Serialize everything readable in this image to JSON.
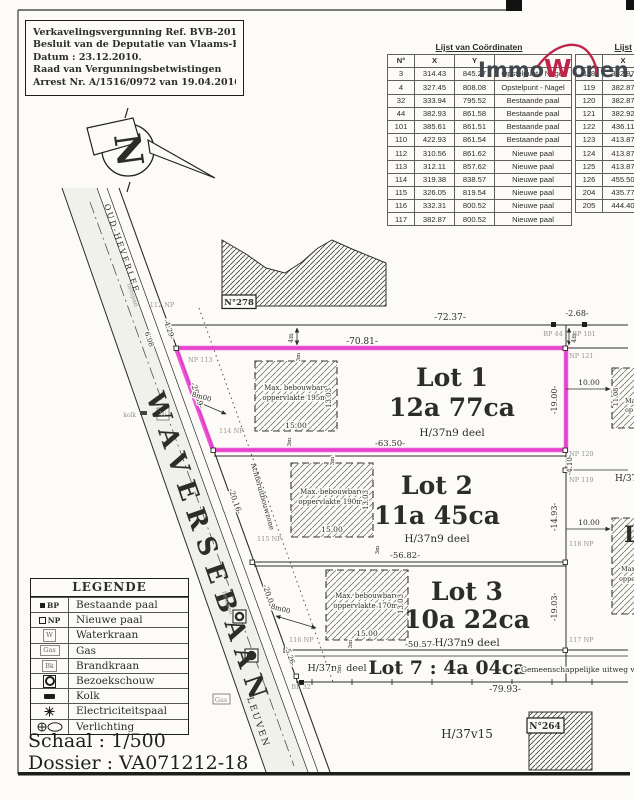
{
  "header": {
    "permit_lines": [
      "Verkavelingsvergunning Ref. BVB-2010581",
      "Besluit van de Deputatie van Vlaams-Brabant",
      "Datum : 23.12.2010.",
      "Raad van Vergunningsbetwistingen",
      "Arrest Nr. A/1516/0972 van 19.04.2016."
    ]
  },
  "logo": {
    "immo": "Immo",
    "w": "W",
    "onen": "onen",
    "be": ".be"
  },
  "coord_table": {
    "title": "Lijst van Coördinaten",
    "columns": [
      "N°",
      "X",
      "Y",
      ""
    ],
    "rows": [
      [
        "3",
        "314.43",
        "845.27",
        "Opstelpunt - Nagel"
      ],
      [
        "4",
        "327.45",
        "808.08",
        "Opstelpunt - Nagel"
      ],
      [
        "32",
        "333.94",
        "795.52",
        "Bestaande paal"
      ],
      [
        "44",
        "382.93",
        "861.58",
        "Bestaande paal"
      ],
      [
        "101",
        "385.61",
        "861.51",
        "Bestaande paal"
      ],
      [
        "110",
        "422.93",
        "861.54",
        "Bestaande paal"
      ],
      [
        "112",
        "310.56",
        "861.62",
        "Nieuwe paal"
      ],
      [
        "113",
        "312.11",
        "857.62",
        "Nieuwe paal"
      ],
      [
        "114",
        "319.38",
        "838.57",
        "Nieuwe paal"
      ],
      [
        "115",
        "326.05",
        "819.54",
        "Nieuwe paal"
      ],
      [
        "116",
        "332.31",
        "800.52",
        "Nieuwe paal"
      ],
      [
        "117",
        "382.87",
        "800.52",
        "Nieuwe paal"
      ]
    ]
  },
  "coord_table_right": {
    "title": "Lijst",
    "columns": [
      "",
      "X"
    ],
    "rows": [
      [
        "118",
        "382.87"
      ],
      [
        "119",
        "382.87"
      ],
      [
        "120",
        "382.87"
      ],
      [
        "121",
        "382.92"
      ],
      [
        "122",
        "436.11"
      ],
      [
        "123",
        "413.87"
      ],
      [
        "124",
        "413.87"
      ],
      [
        "125",
        "413.87"
      ],
      [
        "126",
        "455.50"
      ],
      [
        "204",
        "435.77"
      ],
      [
        "205",
        "444.40"
      ]
    ]
  },
  "plan": {
    "north": "N",
    "parcels": {
      "n278": "N°278",
      "n264": "N°264",
      "h37v15": "H/37v15"
    },
    "road": {
      "name": "WAVERSEBAAN",
      "dir_top": "OUD-HEVERLEE",
      "dir_bottom": "LEUVEN",
      "fietspad": "fietspad",
      "kolk": "kolk",
      "w": "W",
      "gas": "Gas",
      "bk": "Bk"
    },
    "setback": "Achteruitbouwzone",
    "lots": [
      {
        "name": "Lot 1",
        "area": "12a 77ca",
        "deel": "H/37n9 deel",
        "env1": "Max. bebouwbare",
        "env2": "oppervlakte 195m²",
        "w": "15.00",
        "d": "13.03",
        "front": "-63.50-",
        "side": "-19.00-",
        "street": "-20.39-"
      },
      {
        "name": "Lot 2",
        "area": "11a 45ca",
        "deel": "H/37n9 deel",
        "env1": "Max. bebouwbare",
        "env2": "oppervlakte 190m²",
        "w": "15.00",
        "d": "13.03",
        "front": "-56.82-",
        "side": "-14.93-",
        "street": "-20.16-"
      },
      {
        "name": "Lot 3",
        "area": "10a 22ca",
        "deel": "H/37n9 deel",
        "env1": "Max. bebouwbare",
        "env2": "oppervlakte 170m²",
        "w": "15.00",
        "d": "13.03",
        "front": "-50.57-",
        "side": "-19.03-",
        "street": "-20.02-"
      }
    ],
    "lot7": {
      "left": "H/37n9 deel",
      "name": "Lot 7 : 4a 04ca",
      "right": "Gemeenschappelijke uitweg voor d"
    },
    "dims": {
      "d7237": "-72.37-",
      "d268": "-2.68-",
      "d7081": "-70.81-",
      "d429": "-4.29-",
      "d608": "6.08",
      "d1000": "10.00",
      "d1108": "11.08",
      "d410": "-4.10-",
      "d7993": "-79.93-",
      "d526": "-5.26-",
      "d8m": "8m00",
      "d4m": "4m",
      "d3m": "3m",
      "d5m": "5m"
    },
    "points": {
      "p112": "112 NP",
      "p113": "NP 113",
      "p114": "114 NP",
      "p115": "115 NP",
      "p116": "116 NP",
      "p117": "117 NP",
      "p118": "118 NP",
      "p119": "NP 119",
      "p120": "NP 120",
      "p121": "NP 121",
      "bp44": "BP 44",
      "bp101": "BP 101",
      "bp32": "BP 32"
    },
    "fragments": {
      "h37": "H/37",
      "l": "L",
      "max": "Max.",
      "opper": "opper",
      "ma": "Ma",
      "op": "op"
    }
  },
  "legend": {
    "title": "LEGENDE",
    "items": [
      {
        "symbol": "BP",
        "label": "Bestaande paal"
      },
      {
        "symbol": "NP",
        "label": "Nieuwe paal"
      },
      {
        "symbol": "W",
        "label": "Waterkraan"
      },
      {
        "symbol": "Gas",
        "label": "Gas"
      },
      {
        "symbol": "Bk",
        "label": "Brandkraan"
      },
      {
        "symbol": "",
        "label": "Bezoekschouw"
      },
      {
        "symbol": "",
        "label": "Kolk"
      },
      {
        "symbol": "",
        "label": "Electriciteitspaal"
      },
      {
        "symbol": "",
        "label": "Verlichting"
      }
    ]
  },
  "footer": {
    "schaal": "Schaal : 1/500",
    "dossier": "Dossier : VA071212-18"
  }
}
